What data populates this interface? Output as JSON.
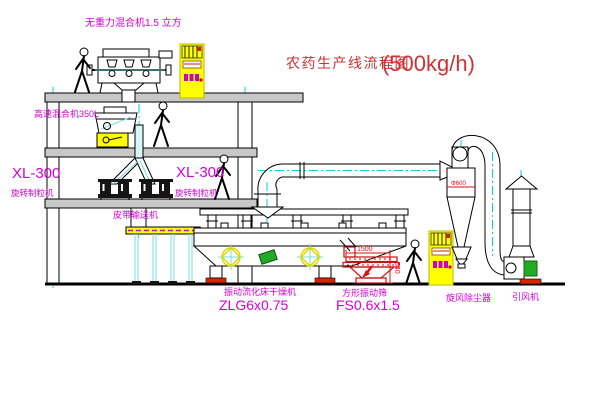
{
  "title": {
    "text": "农药生产线流程图",
    "capacity": "(500kg/h)",
    "color": "#cc3333"
  },
  "labels": {
    "mixer_top": "无重力混合机1.5 立方",
    "mixer_floor2": "高速混合机350L",
    "granulator_left_model": "XL-300",
    "granulator_left_name": "旋转制粒机",
    "granulator_right_model": "XL-300",
    "granulator_right_name": "旋转制粒机",
    "belt_conveyor": "皮带输送机",
    "dryer_name": "振动流化床干燥机",
    "dryer_model": "ZLG6x0.75",
    "screen_name": "方形振动筛",
    "screen_model": "FS0.6x1.5",
    "cyclone": "旋风除尘器",
    "fan": "引风机"
  },
  "dimensions": {
    "screen_width": "1500",
    "screen_height": "540",
    "cyclone_diameter": "Φ600"
  },
  "colors": {
    "label_magenta": "#d400d4",
    "centerline_cyan": "#00d5d5",
    "cabinet_yellow": "#ffff00",
    "dimension_red": "#dd1111",
    "motor_green": "#22aa22",
    "base_red": "#dd2200"
  }
}
